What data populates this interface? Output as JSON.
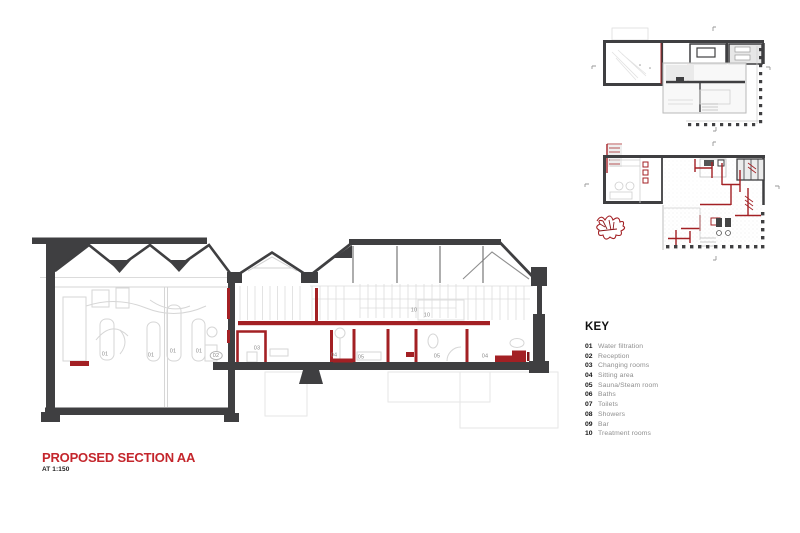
{
  "title_block": {
    "title": "PROPOSED SECTION AA",
    "scale": "AT 1:150"
  },
  "key": {
    "heading": "KEY",
    "items": [
      {
        "num": "01",
        "label": "Water filtration"
      },
      {
        "num": "02",
        "label": "Reception"
      },
      {
        "num": "03",
        "label": "Changing rooms"
      },
      {
        "num": "04",
        "label": "Sitting area"
      },
      {
        "num": "05",
        "label": "Sauna/Steam room"
      },
      {
        "num": "06",
        "label": "Baths"
      },
      {
        "num": "07",
        "label": "Toilets"
      },
      {
        "num": "08",
        "label": "Showers"
      },
      {
        "num": "09",
        "label": "Bar"
      },
      {
        "num": "10",
        "label": "Treatment rooms"
      }
    ]
  },
  "section": {
    "name": "Proposed section AA drawing",
    "labels": [
      {
        "t": "01",
        "x": 105,
        "y": 355
      },
      {
        "t": "01",
        "x": 151,
        "y": 356
      },
      {
        "t": "01",
        "x": 173,
        "y": 352
      },
      {
        "t": "01",
        "x": 199,
        "y": 352
      },
      {
        "t": "02",
        "x": 216,
        "y": 356,
        "oval": true
      },
      {
        "t": "03",
        "x": 257,
        "y": 349
      },
      {
        "t": "04",
        "x": 334,
        "y": 356
      },
      {
        "t": "05",
        "x": 361,
        "y": 358
      },
      {
        "t": "10",
        "x": 414,
        "y": 311
      },
      {
        "t": "10",
        "x": 427,
        "y": 316
      },
      {
        "t": "05",
        "x": 437,
        "y": 357
      },
      {
        "t": "04",
        "x": 485,
        "y": 357
      }
    ]
  },
  "colors": {
    "ink_dark": "#3f3f41",
    "drawing_red": "#a32024",
    "title_red": "#c4262c",
    "light_line": "#d6d6d6",
    "label_gray": "#8a8a8a"
  }
}
